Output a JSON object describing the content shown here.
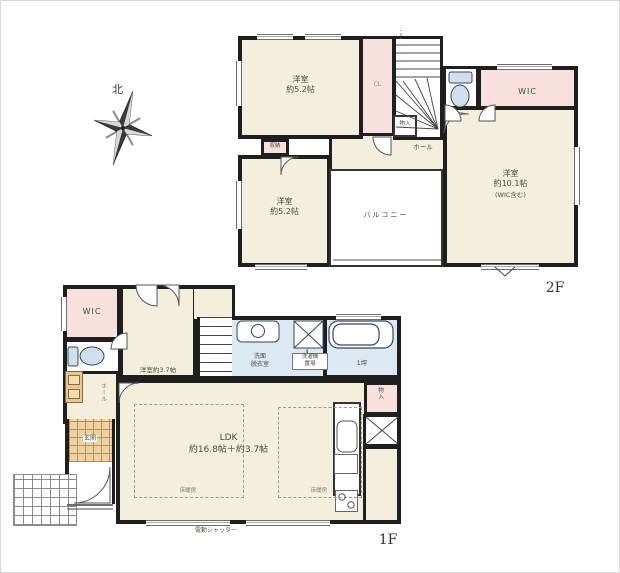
{
  "compass": {
    "north": "北"
  },
  "floor2": {
    "floor_label": "2F",
    "bedroom_a": {
      "name": "洋室",
      "size": "約5.2帖"
    },
    "closet_label": "CL",
    "storage_label": "収納",
    "monoire_label": "物入",
    "hall_label": "ホール",
    "wic_label": "WIC",
    "bedroom_b": {
      "name": "洋室",
      "size": "約5.2帖"
    },
    "balcony_label": "バルコニー",
    "bedroom_c": {
      "name": "洋室",
      "size": "約10.1帖",
      "note": "(WIC含む)"
    }
  },
  "floor1": {
    "floor_label": "1F",
    "wic_label": "WIC",
    "room": {
      "name": "洋室",
      "size": "約3.7帖"
    },
    "hall_label": "ホール",
    "genkan_label": "玄関",
    "washroom": {
      "line1": "洗面",
      "line2": "脱衣室"
    },
    "laundry": {
      "line1": "洗濯機",
      "line2": "置場"
    },
    "bath_label": "1坪",
    "monoire_label": "物入",
    "ldk": {
      "name": "LDK",
      "size": "約16.8帖＋約3.7帖"
    },
    "floorheat_label": "床暖房",
    "shutter_label": "電動シャッター"
  },
  "colors": {
    "wall": "#1f1f1f",
    "room_cream": "#f4efdc",
    "closet_pink": "#f8e0de",
    "wet_blue": "#dde9f2",
    "genkan_tan": "#ecd2a4"
  }
}
